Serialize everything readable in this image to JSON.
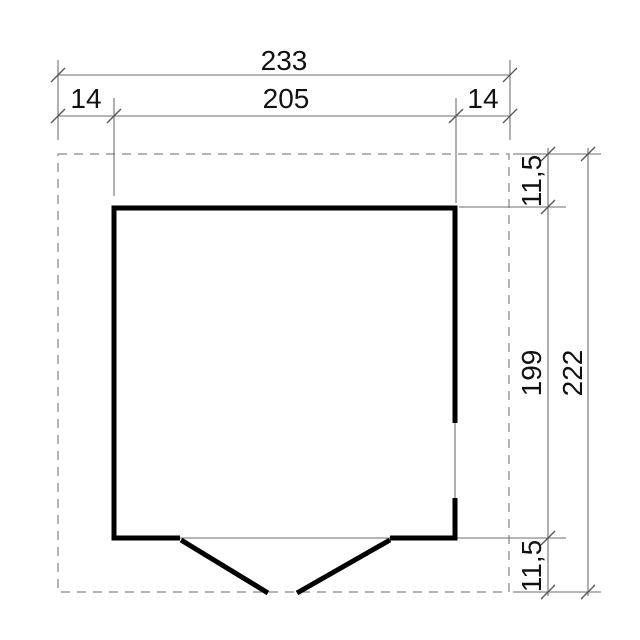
{
  "drawing": {
    "type": "floor-plan",
    "dimensions": {
      "width_total": "233",
      "width_overhang_left": "14",
      "width_wall": "205",
      "width_overhang_right": "14",
      "height_overhang_top": "11,5",
      "height_wall": "199",
      "height_total": "222",
      "height_overhang_bottom": "11,5"
    }
  },
  "colors": {
    "background": "#ffffff",
    "wall": "#000000",
    "dimension_line": "#6e6e6e",
    "dashed_outline": "#9b9b9b",
    "text": "#111111"
  }
}
